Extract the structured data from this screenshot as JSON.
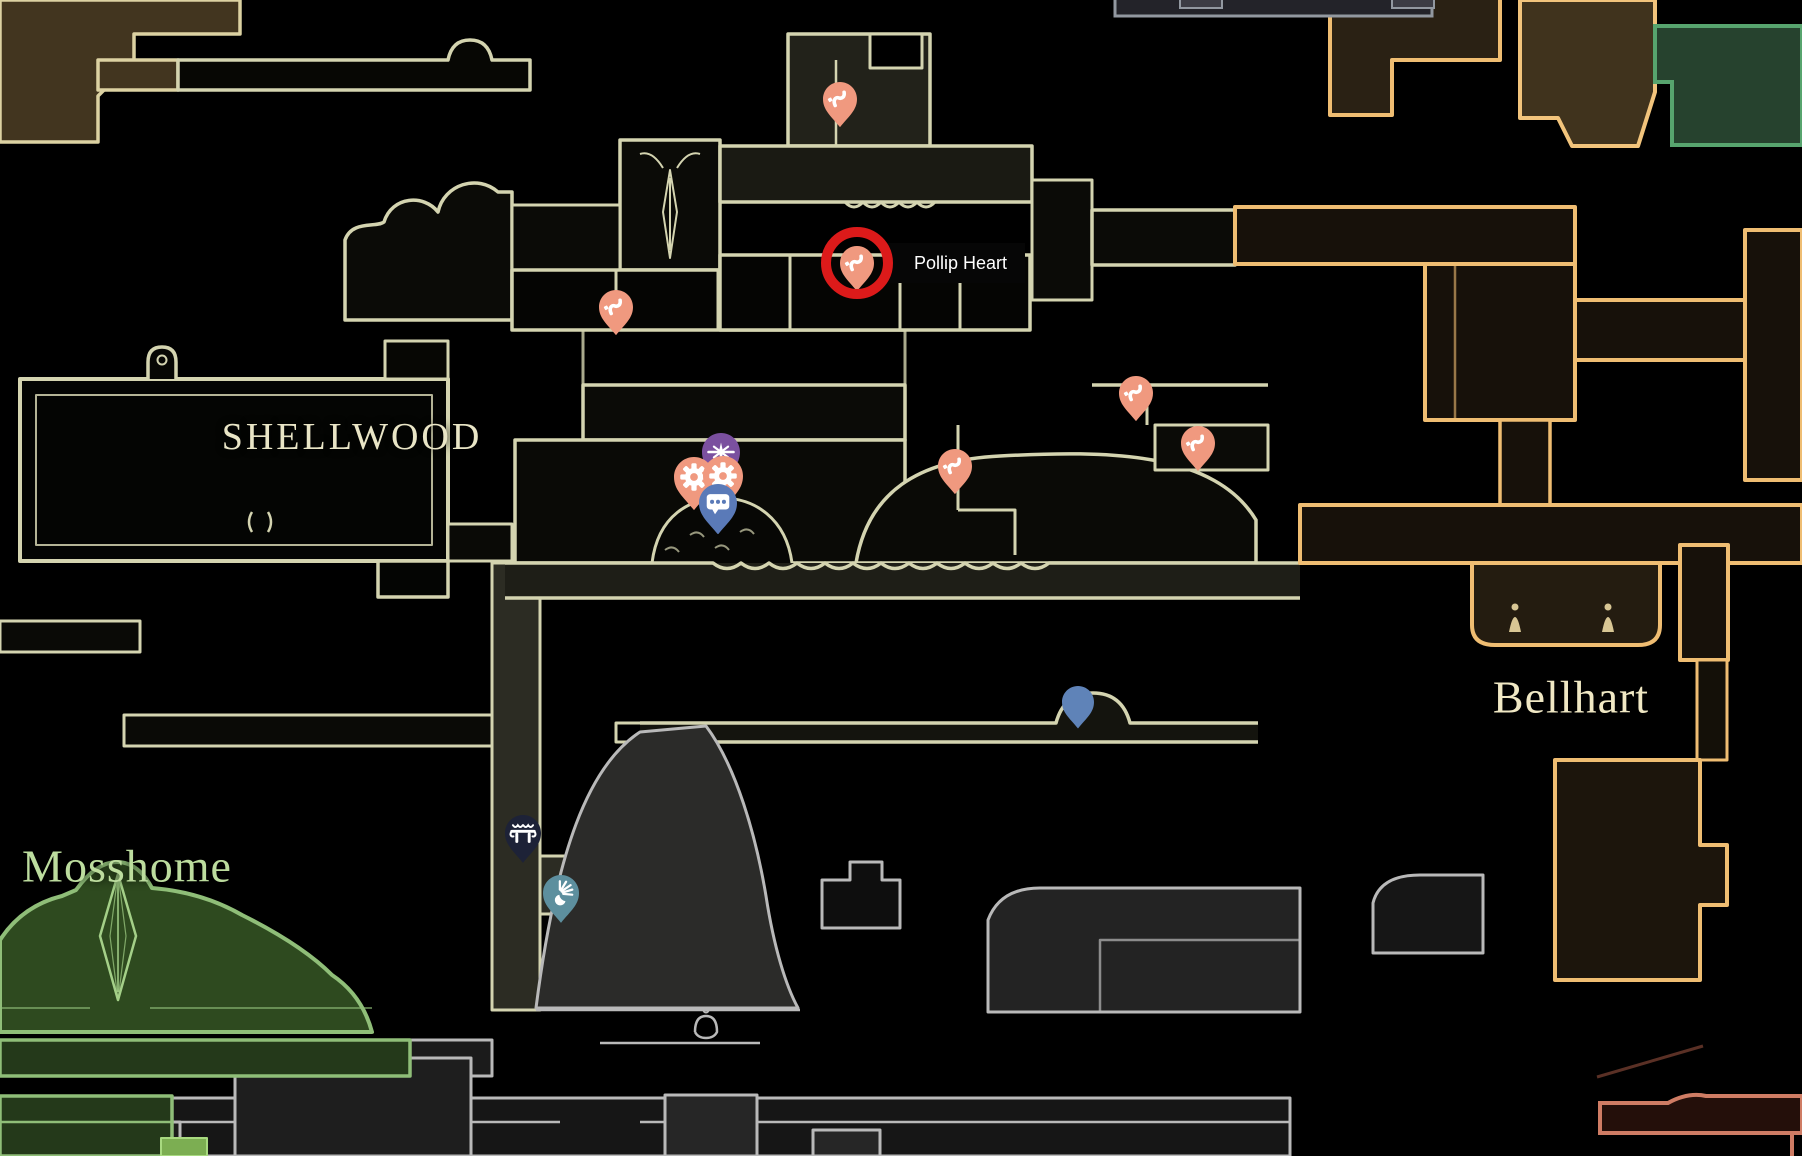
{
  "window": {
    "width": 1802,
    "height": 1156
  },
  "palette": {
    "background": "#000000",
    "shellwood_outline": "#d4d4b0",
    "bellhart_outline": "#efbd72",
    "mosshome_outline": "#8fbe78",
    "gray_outline": "#b9b9b9",
    "green_corridor_outline": "#57a46e",
    "red_corridor_outline": "#cf7c64",
    "annotation_red": "#dc1a1a",
    "flea_pin": "#f0997f",
    "needle_pin": "#7b509f",
    "chat_pin": "#5a7ab8",
    "plain_pin": "#5f83b8",
    "bench_pin": "#1d2237",
    "burst_pin": "#5d8f9e"
  },
  "region_labels": [
    {
      "id": "shellwood",
      "text": "SHELLWOOD",
      "x": 352,
      "y": 437,
      "font_size": 38,
      "color": "#e9e5c6",
      "letter_spacing": 3
    },
    {
      "id": "bellhart",
      "text": "Bellhart",
      "x": 1571,
      "y": 697,
      "font_size": 46,
      "color": "#f0e8c4",
      "letter_spacing": 1
    },
    {
      "id": "mosshome",
      "text": "Mosshome",
      "x": 127,
      "y": 866,
      "font_size": 46,
      "color": "#bcdc9e",
      "letter_spacing": 1
    }
  ],
  "annotation": {
    "label": "Pollip Heart",
    "circle_x": 857,
    "circle_y": 263,
    "circle_radius": 36,
    "color": "#dc1a1a",
    "label_x": 884,
    "label_y": 243,
    "label_bg": "#060606",
    "label_color": "#ffffff"
  },
  "pins": [
    {
      "id": "flea-pin-north",
      "icon": "flea-icon",
      "x": 840,
      "y": 99,
      "size": 34,
      "color": "#f0997f"
    },
    {
      "id": "flea-pin-pollip-heart",
      "icon": "flea-icon",
      "x": 857,
      "y": 263,
      "size": 34,
      "color": "#f0997f"
    },
    {
      "id": "flea-pin-west",
      "icon": "flea-icon",
      "x": 616,
      "y": 307,
      "size": 34,
      "color": "#f0997f"
    },
    {
      "id": "flea-pin-northeast",
      "icon": "flea-icon",
      "x": 1136,
      "y": 393,
      "size": 34,
      "color": "#f0997f"
    },
    {
      "id": "flea-pin-east",
      "icon": "flea-icon",
      "x": 1198,
      "y": 443,
      "size": 34,
      "color": "#f0997f"
    },
    {
      "id": "flea-pin-center",
      "icon": "flea-icon",
      "x": 955,
      "y": 466,
      "size": 34,
      "color": "#f0997f"
    },
    {
      "id": "needle-pin",
      "icon": "needle-icon",
      "x": 721,
      "y": 452,
      "size": 38,
      "color": "#7b509f"
    },
    {
      "id": "gear-pin-left",
      "icon": "gear-icon",
      "x": 694,
      "y": 477,
      "size": 40,
      "color": "#f0997f"
    },
    {
      "id": "gear-pin-right",
      "icon": "gear-icon",
      "x": 723,
      "y": 476,
      "size": 40,
      "color": "#f0997f"
    },
    {
      "id": "chat-pin",
      "icon": "chat-icon",
      "x": 718,
      "y": 503,
      "size": 38,
      "color": "#5a7ab8"
    },
    {
      "id": "plain-pin",
      "icon": "none",
      "x": 1078,
      "y": 702,
      "size": 32,
      "color": "#5f83b8"
    },
    {
      "id": "bench-pin",
      "icon": "bench-icon",
      "x": 523,
      "y": 833,
      "size": 36,
      "color": "#1d2237"
    },
    {
      "id": "burst-pin",
      "icon": "burst-icon",
      "x": 561,
      "y": 893,
      "size": 36,
      "color": "#5d8f9e"
    }
  ]
}
